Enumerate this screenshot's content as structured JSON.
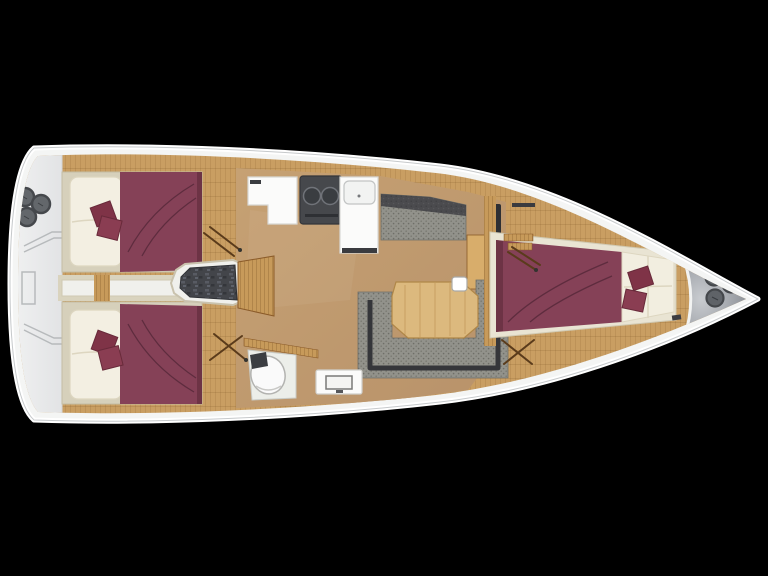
{
  "scene": {
    "label": "Sailing yacht interior floor plan, top-down rendering, bow pointing right",
    "background_color": "#000000"
  },
  "palette": {
    "hull_white": "#f4f5f4",
    "stern_deck": "#eaebec",
    "wood_plank": "#c99e62",
    "wood_light": "#d4ab6e",
    "floor_smooth": "#c09a6c",
    "cabin_base": "#d6d0bb",
    "mattress_cream": "#f3efe2",
    "bed_maroon": "#854157",
    "pillow_maroon": "#7f3347",
    "fabric_gray": "#92928b",
    "fabric_dark": "#4b4b4e",
    "engine_gray": "#43454a",
    "stove_gray": "#46484c",
    "bow_deck_gray": "#9ba0a6",
    "table_wood": "#dcb97e"
  },
  "regions": {
    "hull": {
      "label": "White hull outline with pointed bow to the right"
    },
    "stern_deck": {
      "label": "Stern deck / transom area with three winches",
      "winch_count": 3
    },
    "aft_cabin_port": {
      "label": "Aft cabin port side: double berth with maroon duvet, cream pillows, two maroon cushions"
    },
    "aft_cabin_starboard": {
      "label": "Aft cabin starboard side: double berth with maroon duvet, cream pillows, two maroon cushions"
    },
    "corridor": {
      "label": "Center corridor between aft cabins"
    },
    "companionway": {
      "label": "Companionway with wooden steps over engine compartment"
    },
    "galley": {
      "label": "Galley: white counter, two-burner stove, white sink unit"
    },
    "settee": {
      "label": "Starboard settee bench with dark backrest"
    },
    "salon": {
      "label": "Salon: U-shaped gray sofa around wooden table with cup"
    },
    "chart_area": {
      "label": "Chart desk / locker beside forward bulkhead"
    },
    "head": {
      "label": "Head compartment: toilet and washbasin vanity"
    },
    "forward_cabin": {
      "label": "Forward cabin: V-berth with maroon duvet, cream pillows, two maroon cushions"
    },
    "bow_deck": {
      "label": "Bow deck with three deck fittings",
      "hatch_count": 3
    }
  }
}
